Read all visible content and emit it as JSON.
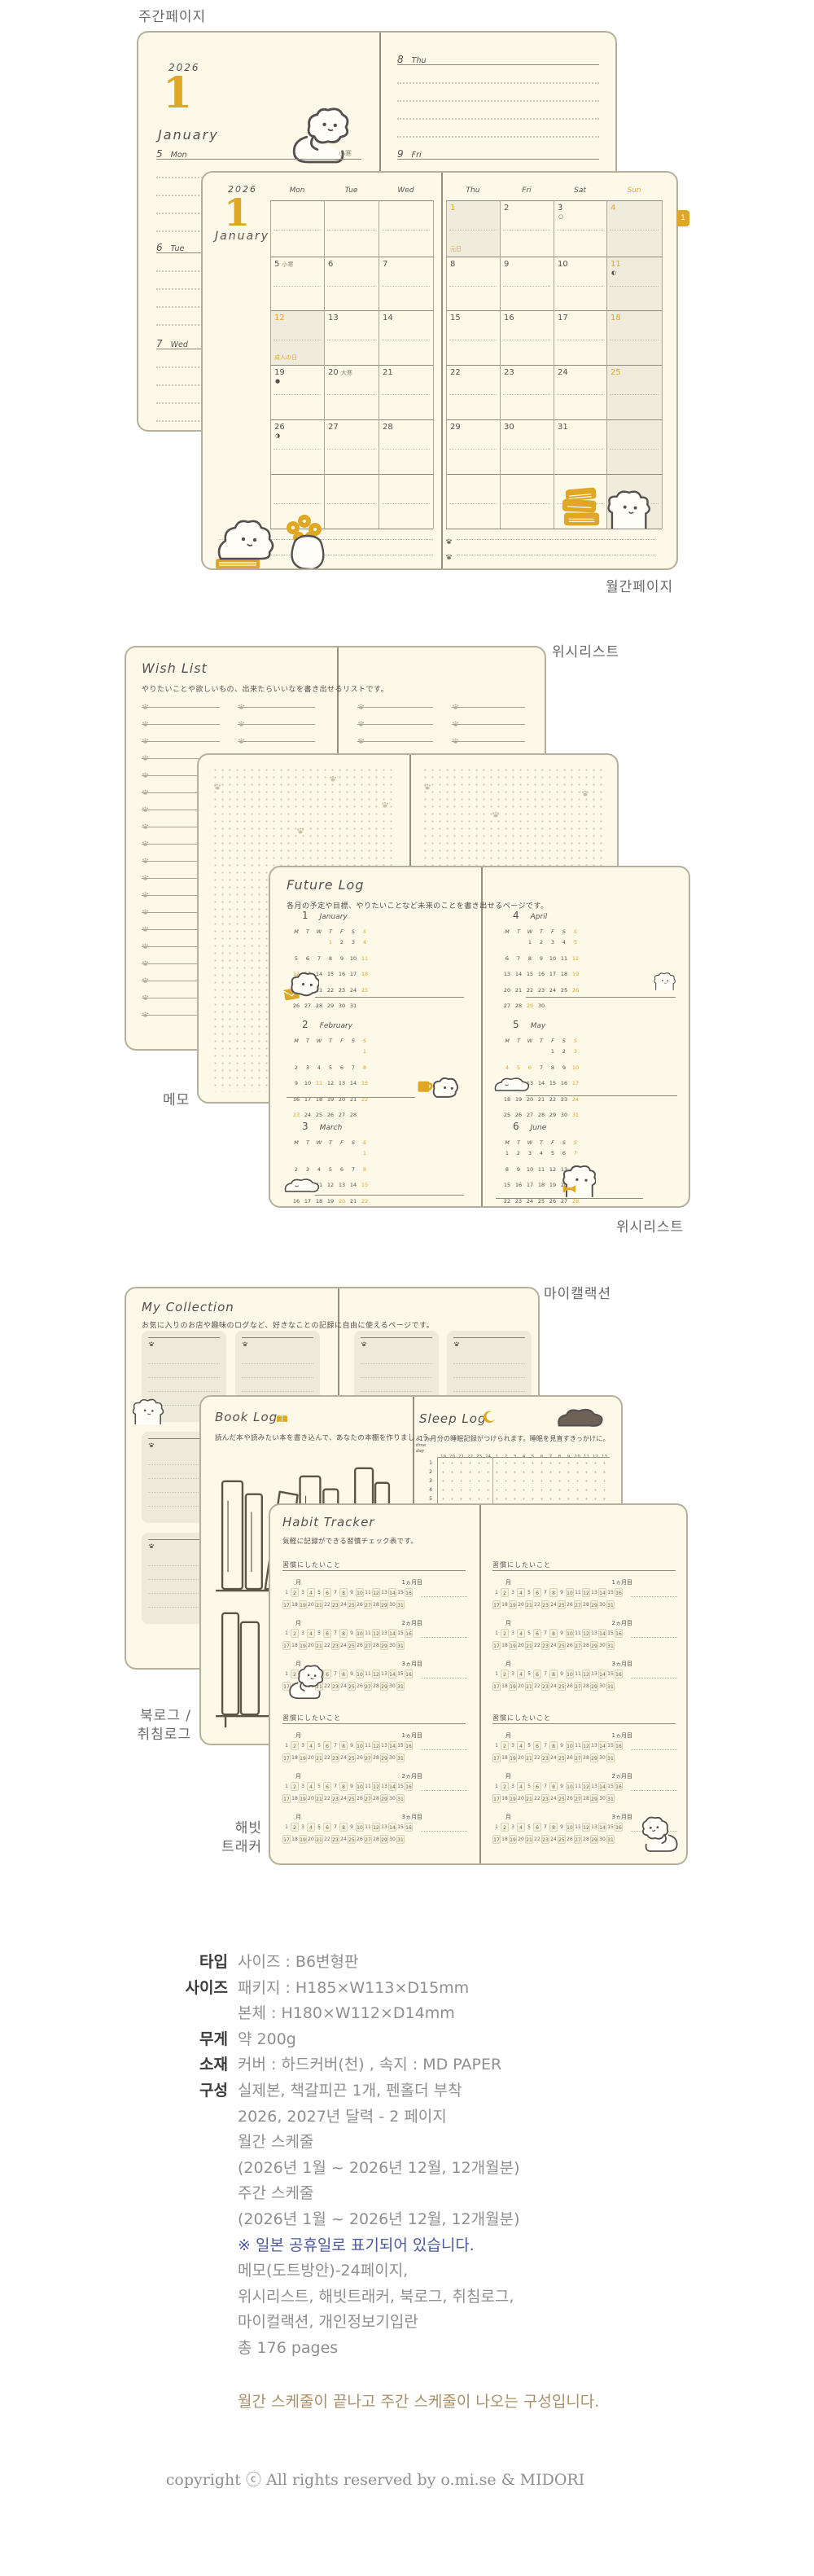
{
  "colors": {
    "accent": "#dfa723",
    "page_bg": "#fcf9e9",
    "page_border": "#b5b09d",
    "ink": "#55504f",
    "grey_note": "#8a8577",
    "shade": "#f0ecdd",
    "label_grey": "#686868",
    "spec_text": "#8f8f8f",
    "spec_label": "#3b3b3b",
    "note_navy": "#4a58a0",
    "note_brown": "#a8906a"
  },
  "section_labels": {
    "weekly_page": "주간페이지",
    "monthly_page": "월간페이지",
    "wishlist_top": "위시리스트",
    "memo": "메모",
    "wishlist_bottom": "위시리스트",
    "my_collection": "마이캘랙션",
    "book_sleep": "북로그 /\n취침로그",
    "habit": "해빗\n트래커"
  },
  "weekly": {
    "year": "2026",
    "month_num": "1",
    "month_name": "January",
    "left_days": [
      {
        "d": "5",
        "name": "Mon",
        "note": "小寒"
      },
      {
        "d": "6",
        "name": "Tue"
      },
      {
        "d": "7",
        "name": "Wed"
      }
    ],
    "right_days": [
      {
        "d": "8",
        "name": "Thu"
      },
      {
        "d": "9",
        "name": "Fri"
      }
    ]
  },
  "monthly": {
    "year": "2026",
    "month_num": "1",
    "month_name": "January",
    "tab": "1",
    "headers_left": [
      "Mon",
      "Tue",
      "Wed"
    ],
    "headers_right": [
      "Thu",
      "Fri",
      "Sat",
      "Sun"
    ],
    "left_rows": [
      [
        null,
        null,
        null
      ],
      [
        {
          "d": "5",
          "note": "小寒"
        },
        {
          "d": "6"
        },
        {
          "d": "7"
        }
      ],
      [
        {
          "d": "12",
          "hl": true,
          "shade": true,
          "holiday": "成人の日"
        },
        {
          "d": "13"
        },
        {
          "d": "14"
        }
      ],
      [
        {
          "d": "19",
          "moon": "●"
        },
        {
          "d": "20",
          "note": "大寒"
        },
        {
          "d": "21"
        }
      ],
      [
        {
          "d": "26",
          "moon": "◑"
        },
        {
          "d": "27"
        },
        {
          "d": "28"
        }
      ],
      [
        null,
        null,
        null
      ]
    ],
    "right_rows": [
      [
        {
          "d": "1",
          "hl": true,
          "shade": true,
          "holiday": "元日"
        },
        {
          "d": "2"
        },
        {
          "d": "3",
          "moon": "○"
        },
        {
          "d": "4",
          "hl": true
        }
      ],
      [
        {
          "d": "8"
        },
        {
          "d": "9"
        },
        {
          "d": "10"
        },
        {
          "d": "11",
          "hl": true,
          "moon": "◐"
        }
      ],
      [
        {
          "d": "15"
        },
        {
          "d": "16"
        },
        {
          "d": "17"
        },
        {
          "d": "18",
          "hl": true
        }
      ],
      [
        {
          "d": "22"
        },
        {
          "d": "23"
        },
        {
          "d": "24"
        },
        {
          "d": "25",
          "hl": true
        }
      ],
      [
        {
          "d": "29"
        },
        {
          "d": "30"
        },
        {
          "d": "31"
        },
        null
      ],
      [
        null,
        null,
        null,
        null
      ]
    ]
  },
  "wishlist": {
    "title": "Wish List",
    "subtitle": "やりたいことや欲しいもの、出来たらいいなを書き出せるリストです。"
  },
  "future_log": {
    "title": "Future Log",
    "subtitle": "各月の予定や目標、やりたいことなど未来のことを書き出せるページです。",
    "week_header": [
      "M",
      "T",
      "W",
      "T",
      "F",
      "S",
      "S"
    ],
    "months": [
      {
        "num": "1",
        "name": "January",
        "offset": 3,
        "days": 31,
        "yellow": [
          1,
          4,
          11,
          12,
          18,
          25
        ]
      },
      {
        "num": "2",
        "name": "February",
        "offset": 6,
        "days": 28,
        "yellow": [
          1,
          8,
          11,
          15,
          22,
          23
        ]
      },
      {
        "num": "3",
        "name": "March",
        "offset": 6,
        "days": 31,
        "yellow": [
          1,
          8,
          15,
          20,
          22,
          29
        ]
      },
      {
        "num": "4",
        "name": "April",
        "offset": 2,
        "days": 30,
        "yellow": [
          5,
          12,
          19,
          26,
          29
        ]
      },
      {
        "num": "5",
        "name": "May",
        "offset": 4,
        "days": 31,
        "yellow": [
          3,
          4,
          5,
          6,
          10,
          17,
          24,
          31
        ]
      },
      {
        "num": "6",
        "name": "June",
        "offset": 0,
        "days": 30,
        "yellow": [
          7,
          14,
          21,
          28
        ]
      }
    ]
  },
  "my_collection": {
    "title": "My Collection",
    "subtitle": "お気に入りのお店や趣味のログなど、好きなことの記録に自由に使えるページです。"
  },
  "book_log": {
    "title": "Book Log",
    "subtitle": "読んだ本や読みたい本を書き込んで、あなたの本棚を作りましょう。"
  },
  "sleep_log": {
    "title": "Sleep Log",
    "subtitle": "1ヵ月分の睡眠記録がつけられます。睡眠を見直すきっかけに。",
    "corner_top": "time",
    "corner_bottom": "day",
    "times": [
      "19",
      "20",
      "21",
      "22",
      "23",
      "24",
      "1",
      "2",
      "3",
      "4",
      "5",
      "6",
      "7",
      "8",
      "9",
      "10",
      "11",
      "12",
      "13"
    ],
    "days": [
      "1",
      "2",
      "3",
      "4",
      "5",
      "6",
      "7"
    ]
  },
  "habit": {
    "title": "Habit Tracker",
    "subtitle": "気軽に記録ができる習慣チェック表です。",
    "block_label": "習慣にしたいこと",
    "month_label": "月",
    "period_labels": [
      "1ヵ月目",
      "2ヵ月目",
      "3ヵ月目"
    ]
  },
  "specs": {
    "rows": [
      {
        "label": "타입",
        "lines": [
          "사이즈 : B6변형판"
        ]
      },
      {
        "label": "사이즈",
        "lines": [
          "패키지 : H185×W113×D15mm",
          "본체 : H180×W112×D14mm"
        ]
      },
      {
        "label": "무게",
        "lines": [
          "약 200g"
        ]
      },
      {
        "label": "소재",
        "lines": [
          "커버 : 하드커버(천) , 속지 : MD PAPER"
        ]
      },
      {
        "label": "구성",
        "lines": [
          "실제본, 책갈피끈 1개, 펜홀더 부착",
          "2026, 2027년 달력 - 2 페이지",
          "월간 스케줄",
          "(2026년 1월 ~ 2026년 12월, 12개월분)",
          "주간 스케줄",
          "(2026년 1월 ~ 2026년 12월, 12개월분)",
          "※ 일본 공휴일로 표기되어 있습니다.",
          "메모(도트방안)-24페이지,",
          "위시리스트, 해빗트래커, 북로그, 취침로그,",
          "마이컬랙션, 개인정보기입란",
          "총 176 pages"
        ]
      }
    ],
    "closing": "월간 스케줄이 끝나고 주간 스케줄이 나오는 구성입니다."
  },
  "footer": "copyright ⓒ All rights reserved by o.mi.se & MIDORI"
}
